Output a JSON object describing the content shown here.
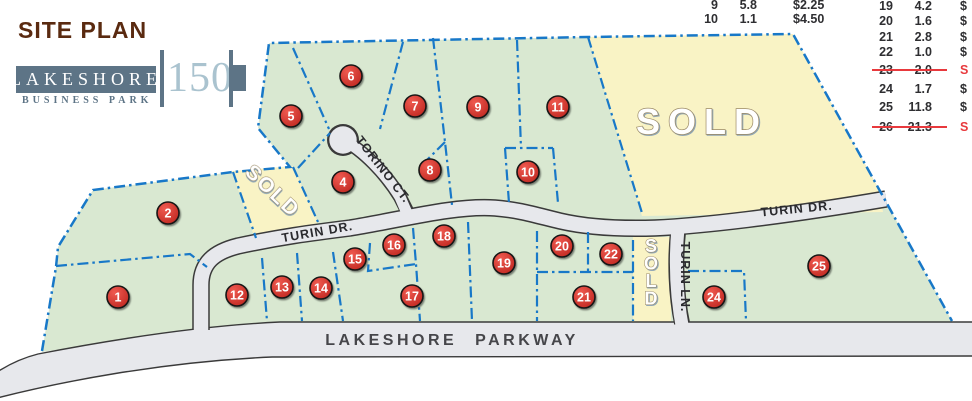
{
  "header": {
    "title": "SITE PLAN"
  },
  "logo": {
    "name": "LAKESHORE",
    "number": "150",
    "subtitle": "BUSINESS PARK"
  },
  "pricing_table": {
    "left_rows": [
      {
        "lot": "9",
        "acres": "5.8",
        "price": "$2.25",
        "sold": false
      },
      {
        "lot": "10",
        "acres": "1.1",
        "price": "$4.50",
        "sold": false
      }
    ],
    "right_rows": [
      {
        "lot": "19",
        "acres": "4.2",
        "price": "$",
        "sold": false
      },
      {
        "lot": "20",
        "acres": "1.6",
        "price": "$",
        "sold": false
      },
      {
        "lot": "21",
        "acres": "2.8",
        "price": "$",
        "sold": false
      },
      {
        "lot": "22",
        "acres": "1.0",
        "price": "$",
        "sold": false
      },
      {
        "lot": "23",
        "acres": "2.0",
        "price": "S",
        "sold": true
      },
      {
        "lot": "24",
        "acres": "1.7",
        "price": "$",
        "sold": false
      },
      {
        "lot": "25",
        "acres": "11.8",
        "price": "$",
        "sold": false
      },
      {
        "lot": "26",
        "acres": "21.3",
        "price": "S",
        "sold": true
      }
    ]
  },
  "map": {
    "road_labels": {
      "turin_dr": "TURIN DR.",
      "torino_ct": "TORINO CT.",
      "turin_ln": "TURIN LN.",
      "lakeshore_pkwy": "LAKESHORE PARKWAY"
    },
    "sold_label": "SOLD",
    "lots": [
      {
        "number": "1",
        "x": 118,
        "y": 297
      },
      {
        "number": "2",
        "x": 168,
        "y": 213
      },
      {
        "number": "4",
        "x": 343,
        "y": 182
      },
      {
        "number": "5",
        "x": 291,
        "y": 116
      },
      {
        "number": "6",
        "x": 351,
        "y": 76
      },
      {
        "number": "7",
        "x": 415,
        "y": 106
      },
      {
        "number": "8",
        "x": 430,
        "y": 170
      },
      {
        "number": "9",
        "x": 478,
        "y": 107
      },
      {
        "number": "10",
        "x": 528,
        "y": 172
      },
      {
        "number": "11",
        "x": 558,
        "y": 107
      },
      {
        "number": "12",
        "x": 237,
        "y": 295
      },
      {
        "number": "13",
        "x": 282,
        "y": 287
      },
      {
        "number": "14",
        "x": 321,
        "y": 288
      },
      {
        "number": "15",
        "x": 355,
        "y": 259
      },
      {
        "number": "16",
        "x": 394,
        "y": 245
      },
      {
        "number": "17",
        "x": 412,
        "y": 296
      },
      {
        "number": "18",
        "x": 444,
        "y": 236
      },
      {
        "number": "19",
        "x": 504,
        "y": 263
      },
      {
        "number": "20",
        "x": 562,
        "y": 246
      },
      {
        "number": "21",
        "x": 584,
        "y": 297
      },
      {
        "number": "22",
        "x": 611,
        "y": 254
      },
      {
        "number": "24",
        "x": 714,
        "y": 297
      },
      {
        "number": "25",
        "x": 819,
        "y": 266
      }
    ],
    "colors": {
      "parcel_green": "#d9e8d1",
      "sold_yellow": "#f9f3c5",
      "road_fill": "#e7e8ec",
      "road_edge": "#3a3a3a",
      "boundary_blue": "#1878c8",
      "marker_red": "#d6342c",
      "strike_red": "#e8393d",
      "logo_slate": "#5d7486",
      "logo_light_blue": "#aac3cf",
      "title_brown": "#5a2a10"
    }
  }
}
